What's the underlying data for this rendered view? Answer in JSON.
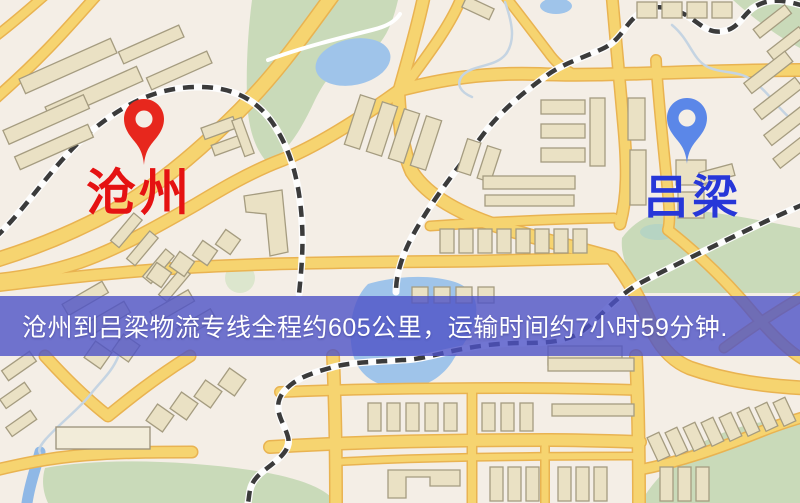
{
  "app": {
    "type": "logistics-route-map",
    "description_visible": false
  },
  "banner": {
    "text": "沧州到吕梁物流专线全程约605公里，运输时间约7小时59分钟.",
    "background_color": "#4d52c7",
    "text_color": "#ffffff"
  },
  "origin": {
    "name": "沧州",
    "label_color": "#e51212",
    "pin_color": "#e7271d",
    "pin_icon": "map-pin"
  },
  "destination": {
    "name": "吕梁",
    "label_color": "#2737d8",
    "pin_color": "#5b87e8",
    "pin_icon": "map-pin"
  },
  "route": {
    "distance_text": "约605公里",
    "duration_text": "约7小时59分钟"
  },
  "map": {
    "style": "stylized-street-map",
    "colors": {
      "land": "#f4eee6",
      "park": "#c9dab9",
      "water": "#9fc4ea",
      "road_major": "#f6d470",
      "road_casing": "#e9b351",
      "railway_dash": "#3b3b3b",
      "building_fill": "#eae1c4",
      "building_outline": "#a59c80"
    },
    "features": [
      "parks",
      "ponds",
      "river",
      "major-roads",
      "minor-roads",
      "railways",
      "buildings"
    ]
  }
}
